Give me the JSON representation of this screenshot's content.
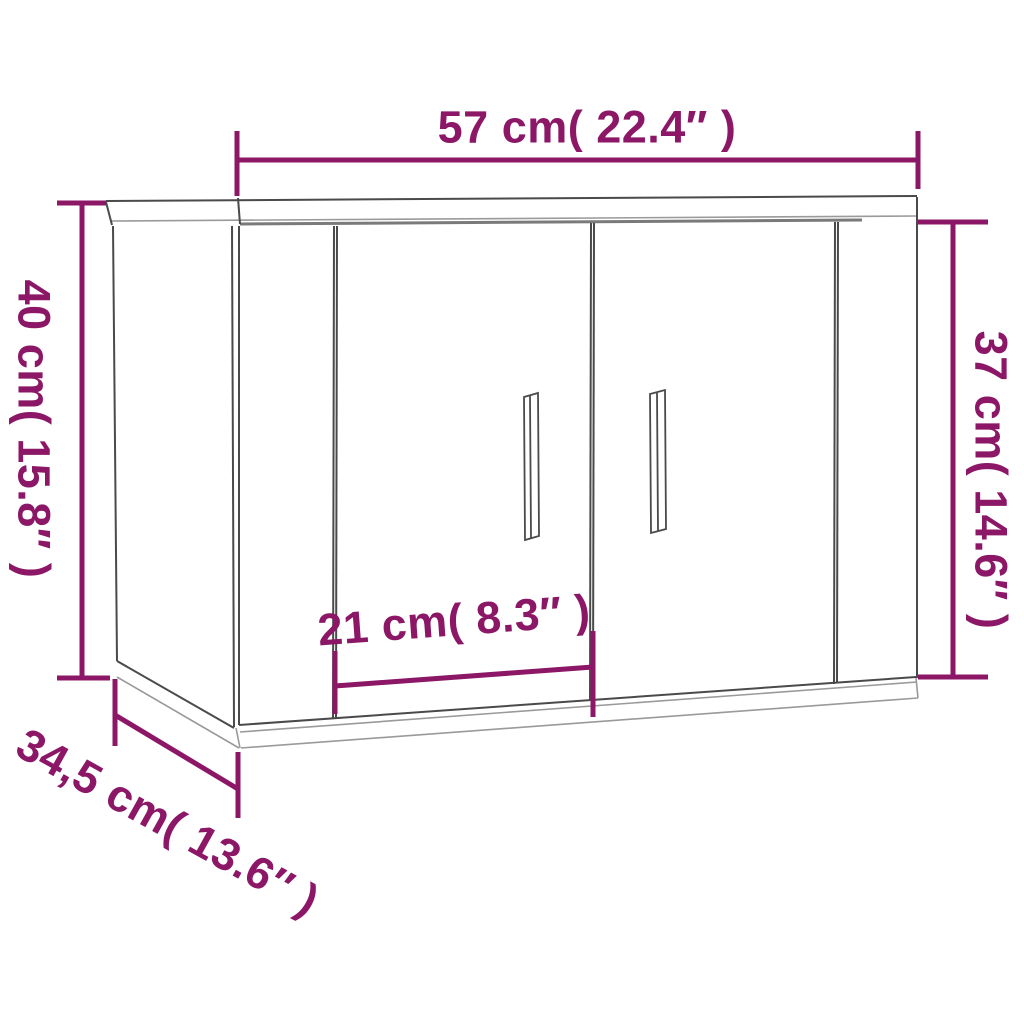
{
  "diagram": {
    "kind": "furniture-dimension-diagram",
    "subject": "wall-mounted two-door cabinet drawn in perspective",
    "background": "#FFFFFF",
    "accent_color": "#8B1766",
    "cabinet": {
      "line_dark": "#4A4A4A",
      "line_mid": "#7A7A7A",
      "line_light": "#9A9A9A",
      "panel_fill": "#FFFFFF"
    },
    "dimensions": {
      "width": {
        "label": "57 cm( 22.4″ )",
        "value_cm": "57",
        "value_in": "22.4″",
        "position": "top",
        "orientation": "horizontal"
      },
      "height_left": {
        "label": "40 cm( 15.8″ )",
        "value_cm": "40",
        "value_in": "15.8″",
        "position": "left",
        "orientation": "vertical"
      },
      "height_right": {
        "label": "37 cm( 14.6″ )",
        "value_cm": "37",
        "value_in": "14.6″",
        "position": "right",
        "orientation": "vertical"
      },
      "door_width": {
        "label": "21 cm( 8.3″ )",
        "value_cm": "21",
        "value_in": "8.3″",
        "position": "center-lower",
        "orientation": "slanted"
      },
      "depth": {
        "label": "34,5 cm( 13.6″ )",
        "value_cm": "34,5",
        "value_in": "13.6″",
        "position": "bottom-left",
        "orientation": "diagonal"
      }
    }
  }
}
